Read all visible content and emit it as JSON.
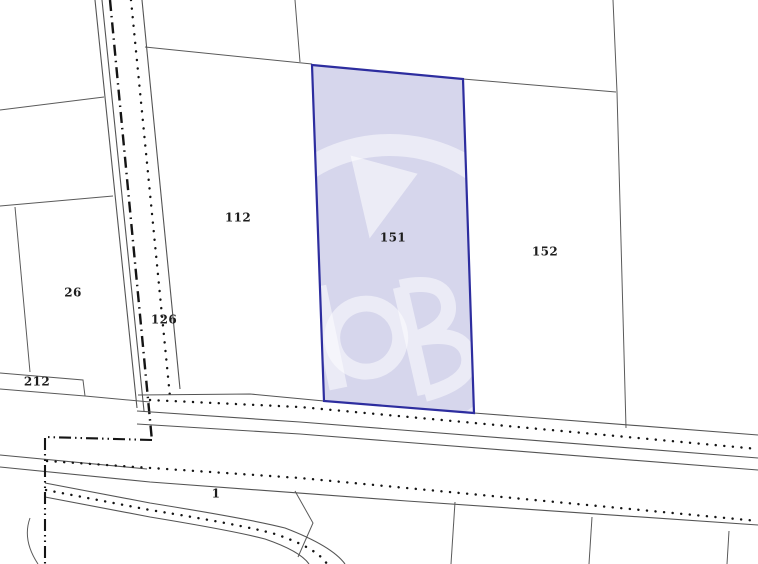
{
  "map": {
    "type": "cadastral-parcel-map",
    "background_color": "#ffffff",
    "boundary_line_color": "#545454",
    "marker_line_color": "#141414",
    "watermark_color": "rgba(255,255,255,0.5)",
    "highlight": {
      "label": "151",
      "fill_color": "#d6d6ec",
      "border_color": "#2d2d9f"
    },
    "parcels": [
      {
        "label": "112",
        "x": 238,
        "y": 218
      },
      {
        "label": "151",
        "x": 393,
        "y": 238
      },
      {
        "label": "152",
        "x": 545,
        "y": 252
      },
      {
        "label": "26",
        "x": 73,
        "y": 293
      },
      {
        "label": "126",
        "x": 164,
        "y": 320
      },
      {
        "label": "212",
        "x": 37,
        "y": 382
      },
      {
        "label": "1",
        "x": 216,
        "y": 494
      }
    ]
  }
}
